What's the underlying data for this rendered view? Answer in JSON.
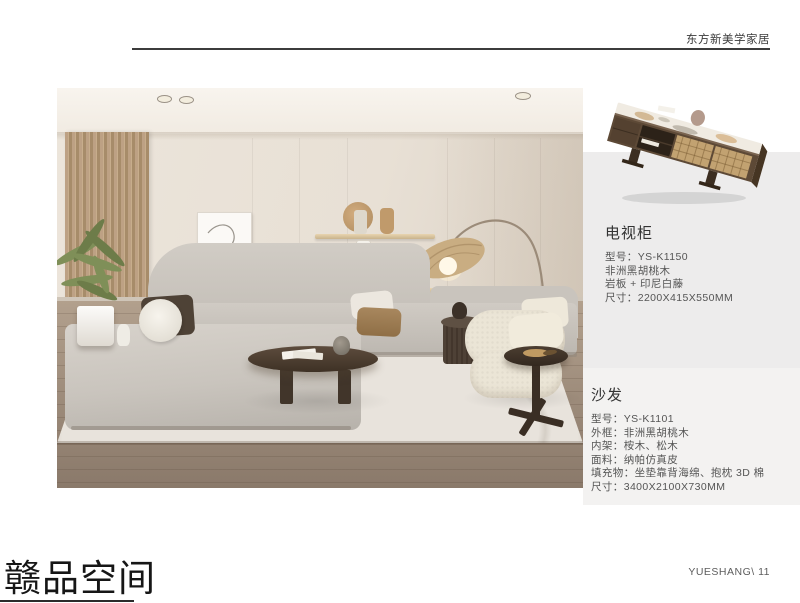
{
  "header": {
    "brand": "东方新美学家居"
  },
  "products": {
    "tv_cabinet": {
      "title": "电视柜",
      "specs": [
        "型号：YS-K1150",
        "非洲黑胡桃木",
        "岩板 + 印尼白藤",
        "尺寸：2200X415X550MM"
      ]
    },
    "sofa": {
      "title": "沙发",
      "specs": [
        "型号：YS-K1101",
        "外框：非洲黑胡桃木",
        "内架：桉木、松木",
        "面料：纳帕仿真皮",
        "填充物：坐垫靠背海绵、抱枕 3D 棉",
        "尺寸：3400X2100X730MM"
      ]
    }
  },
  "footer": {
    "series_title": "赣品空间",
    "page_label": "YUESHANG\\ 11"
  },
  "colors": {
    "panel_bg": "#edecec",
    "wood_dark": "#5d4936",
    "rattan": "#c2a271",
    "text_primary": "#333333",
    "text_secondary": "#555555"
  }
}
